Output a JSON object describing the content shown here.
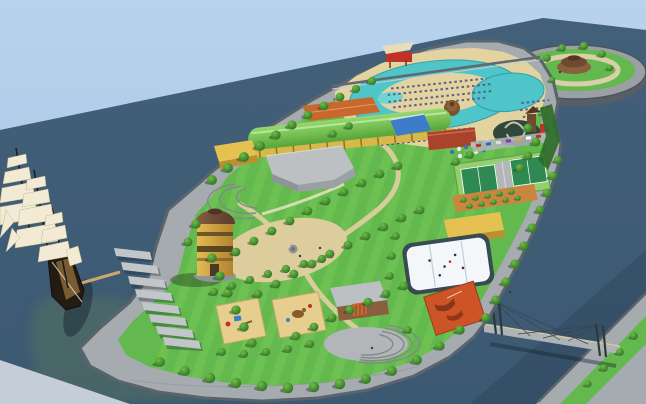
{
  "meta": {
    "domain": "Natural-Image",
    "subject": "aerial-3d-render-of-waterfront-leisure-park-island"
  },
  "palette": {
    "sky": "#aecbe8",
    "water": "#3f5c75",
    "water_shadow": "#2c455c",
    "corner_wedge": "#c5cdd8",
    "promenade": "#a6abaf",
    "seawall": "#5a646c",
    "grass": "#63b94e",
    "grass_stripe": "#7ccd5a",
    "tree_dark": "#2e6b26",
    "sand_deck": "#e3d3a0",
    "path_sand": "#ddcd9d",
    "pool_water": "#4fc4c9",
    "pool_water_light": "#6fd4d4",
    "roof_green": "#6dbf4c",
    "roof_orange": "#c8682f",
    "roof_red": "#a9432c",
    "roof_yellow": "#e5c152",
    "roof_blue": "#3d7cc9",
    "roof_grey": "#bcc0c3",
    "wall_yellow": "#d9b84a",
    "tower_body": "#d2a23c",
    "tower_dome": "#6f4a33",
    "rink_ice": "#f4f7f9",
    "rink_boards": "#3a4a52",
    "skate_park": "#cd5427",
    "tennis_apron": "#93cf6e",
    "tennis_court": "#2e8a52",
    "orchard": "#c9863f",
    "bridge_deck": "#aeb3b6",
    "ship_sail": "#f2ead2",
    "ship_hull": "#241c12",
    "playground_sand": "#e6cf8e"
  },
  "scene": {
    "elements": [
      "sky",
      "river-water",
      "sailing-ship",
      "ship-gangway",
      "marina-piers",
      "main-island",
      "central-lawn",
      "water-tower",
      "sand-plaza",
      "playgrounds",
      "green-hall-building",
      "pool-complex",
      "lazy-river-pool",
      "water-slide",
      "pool-bar-huts",
      "sun-loungers",
      "tennis-courts",
      "car-park",
      "orchard-terrace",
      "ice-rink",
      "skate-park",
      "amphitheater-stage",
      "circular-island",
      "round-pavilion",
      "pedestrian-bridge",
      "far-shore",
      "tree-rows",
      "waterfront-promenade"
    ]
  }
}
